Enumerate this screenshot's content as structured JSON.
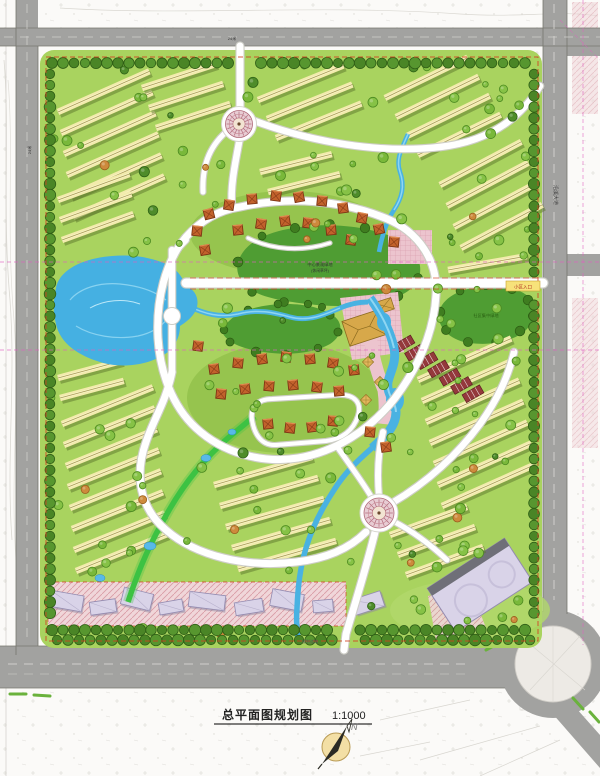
{
  "title_block": {
    "title": "总平面图规划图",
    "scale": "1:1000",
    "north_label": "N"
  },
  "map_labels": {
    "central_lawn_line1": "中心景观绿地",
    "central_lawn_line2": "(休闲草坪)",
    "east_lawn": "社区集中绿地",
    "east_entrance": "小区入口",
    "east_road_name": "沿溪大道",
    "top_road_width": "24米",
    "left_road_width": "24米",
    "bottom_road_note": "规划道路"
  },
  "palette": {
    "site_green": "#a9d35f",
    "zone_green": "#93c24d",
    "tree_green": "#86c246",
    "tree_green2": "#79b83a",
    "tree_dark": "#4e8c2a",
    "tree_orange": "#cd8a3c",
    "border_tree": "#57962f",
    "border_tree2": "#4a8526",
    "hill_green": "#4f9d33",
    "lake_blue": "#45b0e2",
    "lake_light": "#8fd6f2",
    "stream_green": "#3dc243",
    "road_gray": "#a2a2a0",
    "island_gray": "#edeae5",
    "townhouse_cream": "#f2ebac",
    "townhouse_shadow": "#5d772c",
    "villa_orange": "#c2622c",
    "villa_line": "#7e3514",
    "plaza_pink": "#ecc4ce",
    "commercial_lavender": "#d9d3e8",
    "stall_maroon": "#94393c",
    "club_gold": "#d7a84a",
    "boundary_red": "#d04020",
    "utility_magenta": "#e060c0"
  }
}
